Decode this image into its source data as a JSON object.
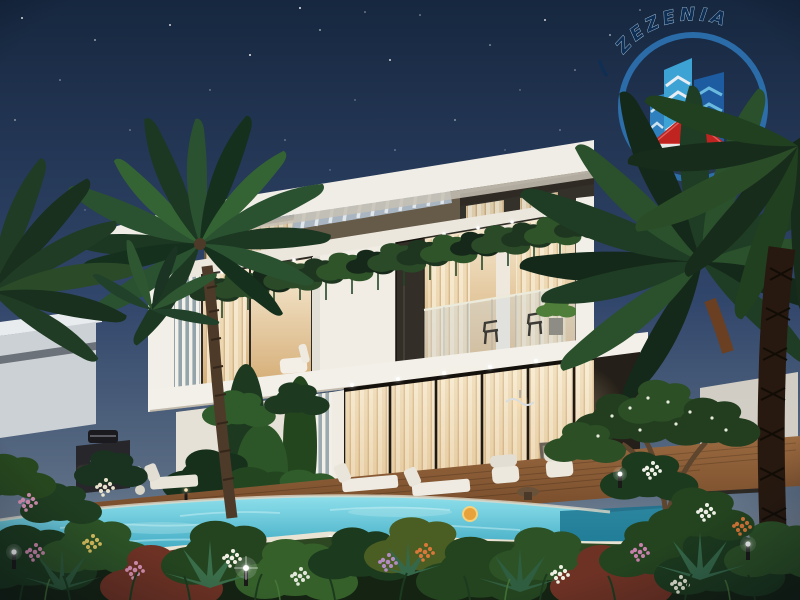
{
  "watermark": {
    "text": "ZEZENIA",
    "ring_color": "#2f7bc0",
    "text_color": "#10optional",
    "text_navy": "#0e2f55",
    "building_light_blue": "#3fa9dc",
    "building_dark_blue": "#1f5fa6",
    "roof_red": "#c8241e",
    "house_white": "#f2f2f0"
  },
  "palette": {
    "sky_top": "#16273f",
    "sky_mid": "#31466b",
    "sky_horizon": "#99a2ad",
    "villa_white": "#f0ede6",
    "interior_glow": "#f6e3bd",
    "pool_light": "#8fe0ec",
    "pool_deep": "#2b9cb8",
    "deck_wood": "#8a5a36",
    "foliage_dark": "#1c3822",
    "foliage_light": "#3d6b38",
    "flower_pink": "#d892b4",
    "flower_white": "#f0f0e4",
    "flower_orange": "#d97838"
  }
}
